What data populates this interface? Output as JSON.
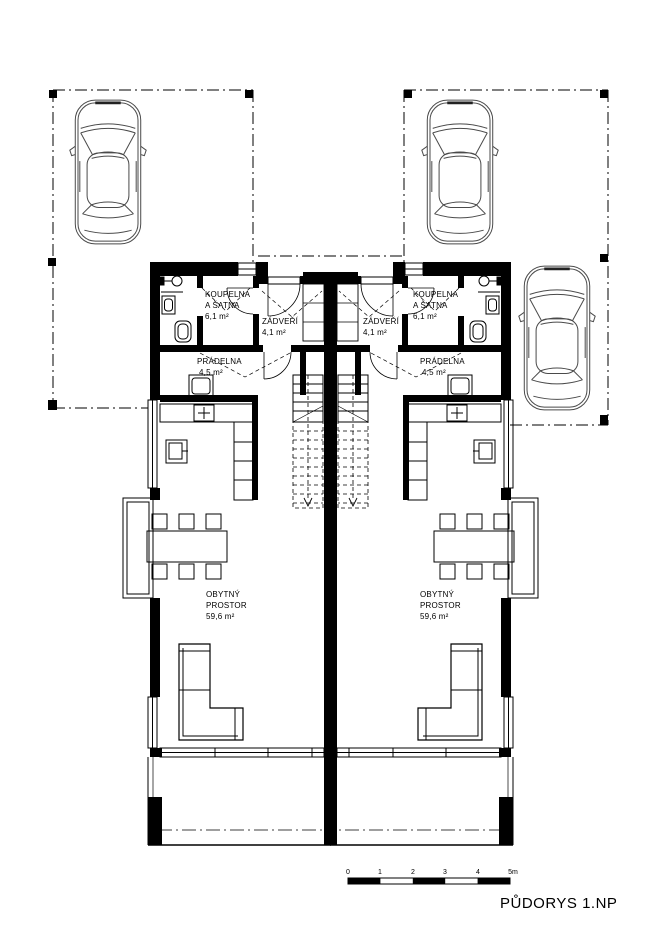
{
  "title": "PŮDORYS 1.NP",
  "colors": {
    "line": "#000000",
    "background": "#ffffff",
    "car_line": "#4a4a4a"
  },
  "rooms": {
    "koupelna": {
      "line1": "KOUPELNA",
      "line2": "A ŠATNA",
      "area": "6,1 m²"
    },
    "zadveri": {
      "line1": "ZÁDVEŘÍ",
      "area": "4,1 m²"
    },
    "pradelna": {
      "line1": "PRÁDELNA",
      "area": "4,5 m²"
    },
    "obytny": {
      "line1": "OBYTNÝ",
      "line2": "PROSTOR",
      "area": "59,6 m²"
    }
  },
  "scale_bar": {
    "unit_labels": [
      "0",
      "1",
      "2",
      "3",
      "4",
      "5m"
    ]
  }
}
